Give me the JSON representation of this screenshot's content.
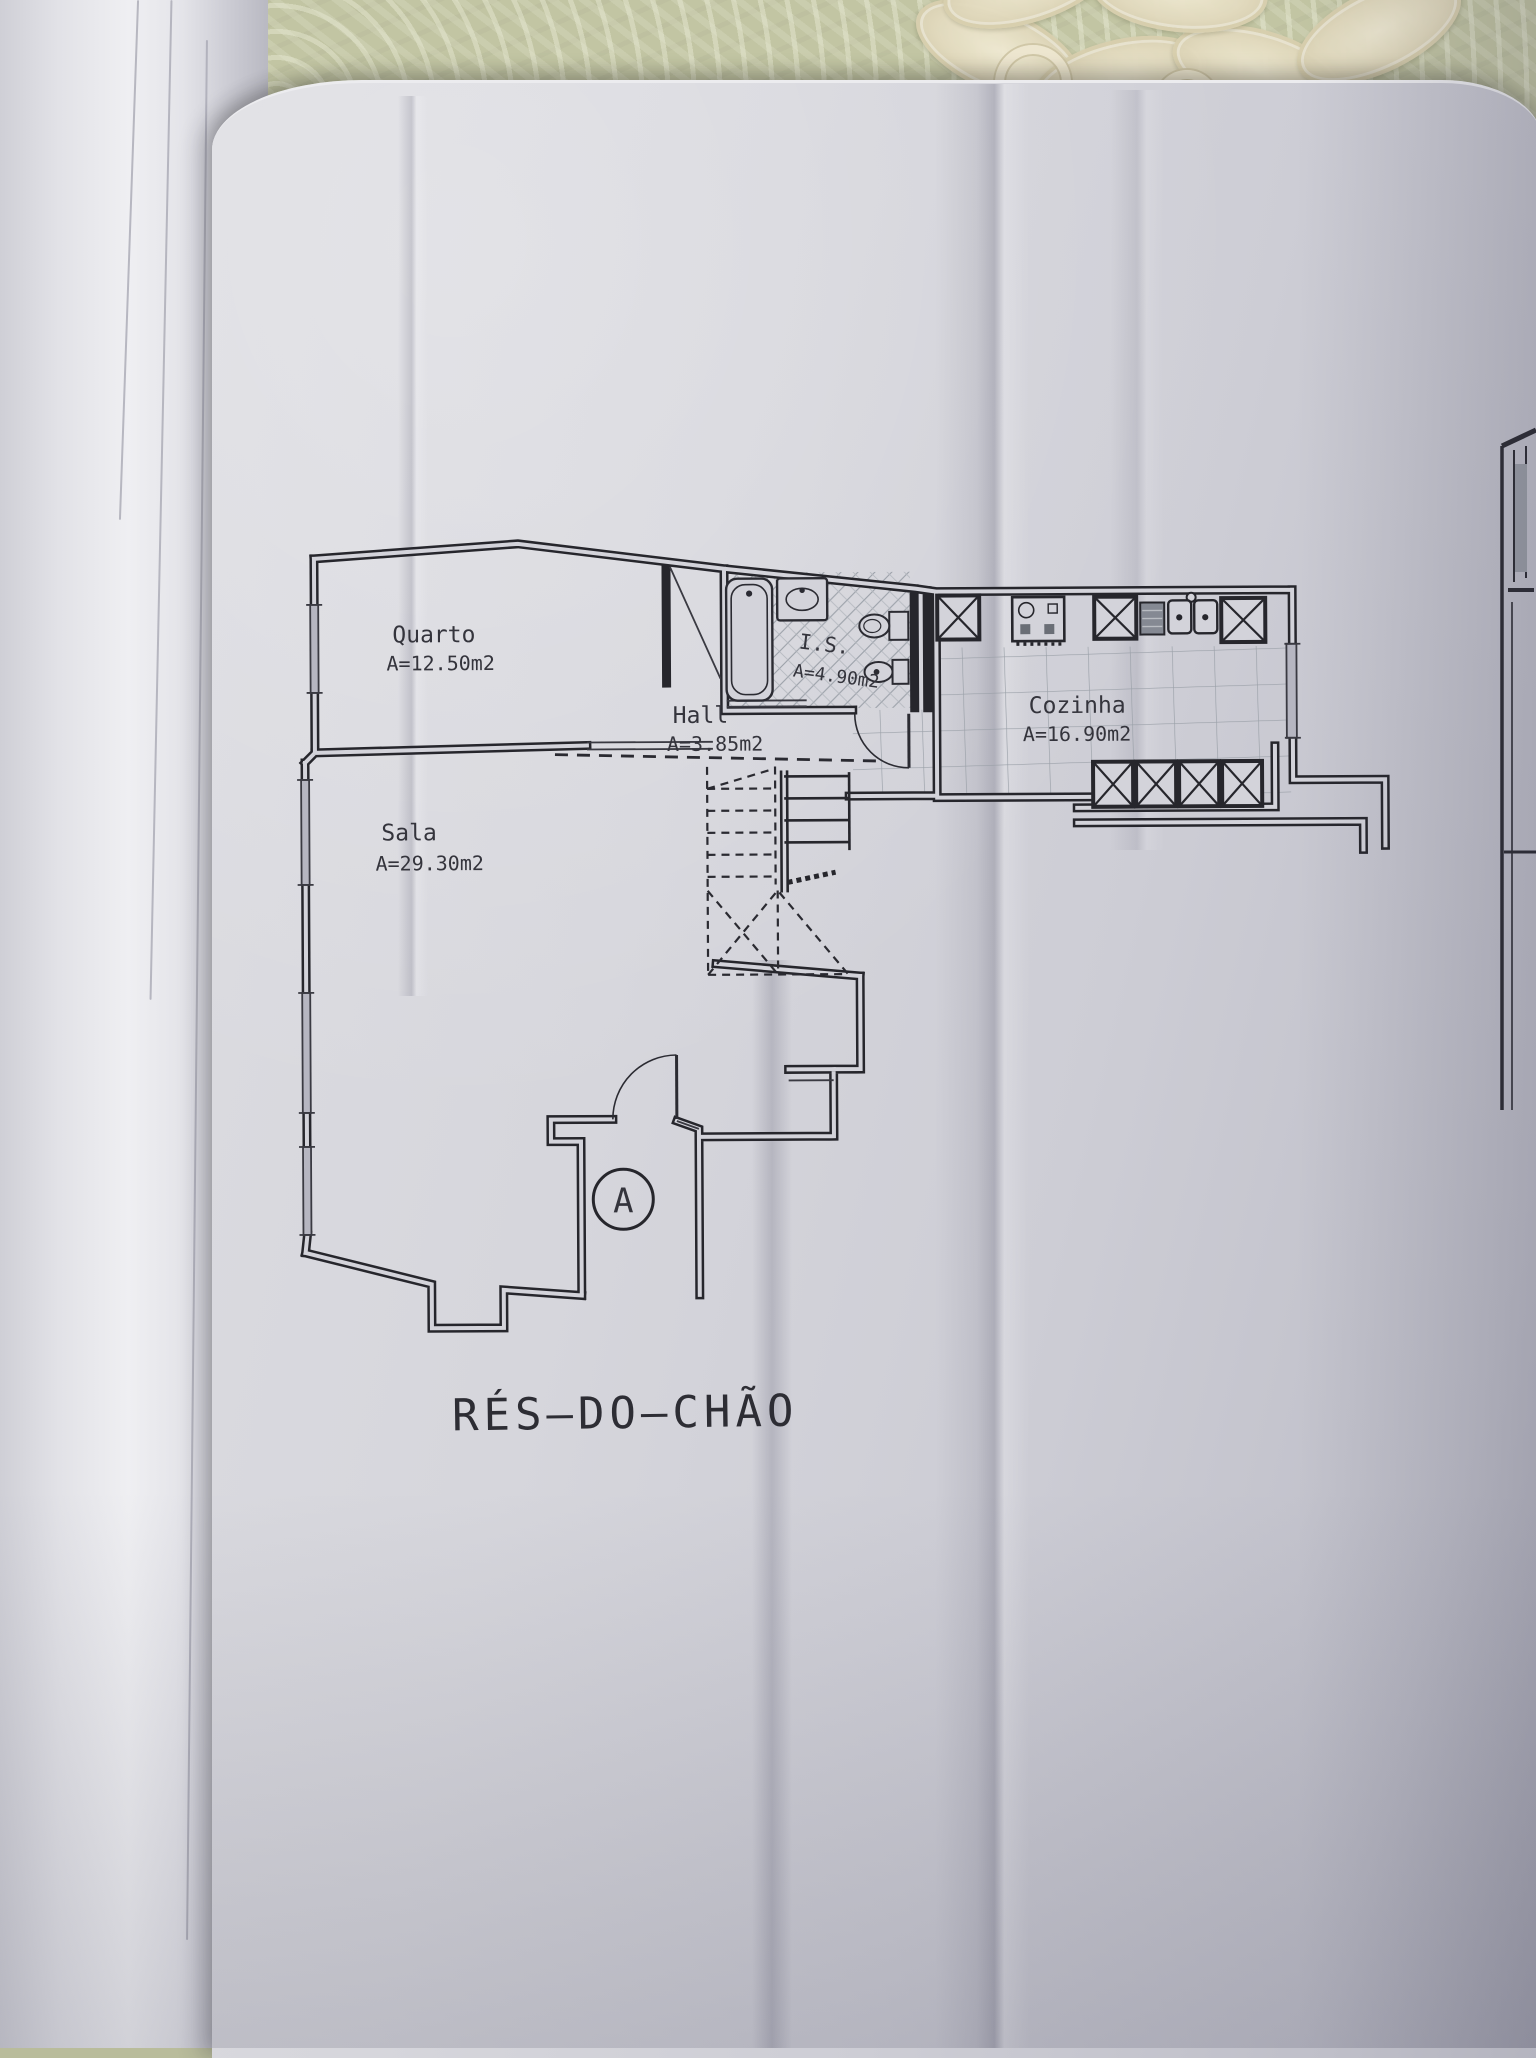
{
  "plan": {
    "title": "RÉS—DO—CHÃO",
    "rooms": [
      {
        "name": "Quarto",
        "area": "A=12.50m2"
      },
      {
        "name": "Sala",
        "area": "A=29.30m2"
      },
      {
        "name": "Hall",
        "area": "A=3.85m2"
      },
      {
        "name": "I.S.",
        "area": "A=4.90m2"
      },
      {
        "name": "Cozinha",
        "area": "A=16.90m2"
      }
    ],
    "entrance_marker": "A",
    "features": [
      "staircase",
      "bathtub",
      "washbasin",
      "toilet",
      "bidet",
      "kitchen-counter",
      "entrance-door"
    ]
  },
  "colors": {
    "paper": "#d3d3da",
    "ink": "#26262c",
    "tile_line": "#9aa0a8",
    "tablecloth": "#c2c5a3",
    "lace": "#eee7d0"
  }
}
